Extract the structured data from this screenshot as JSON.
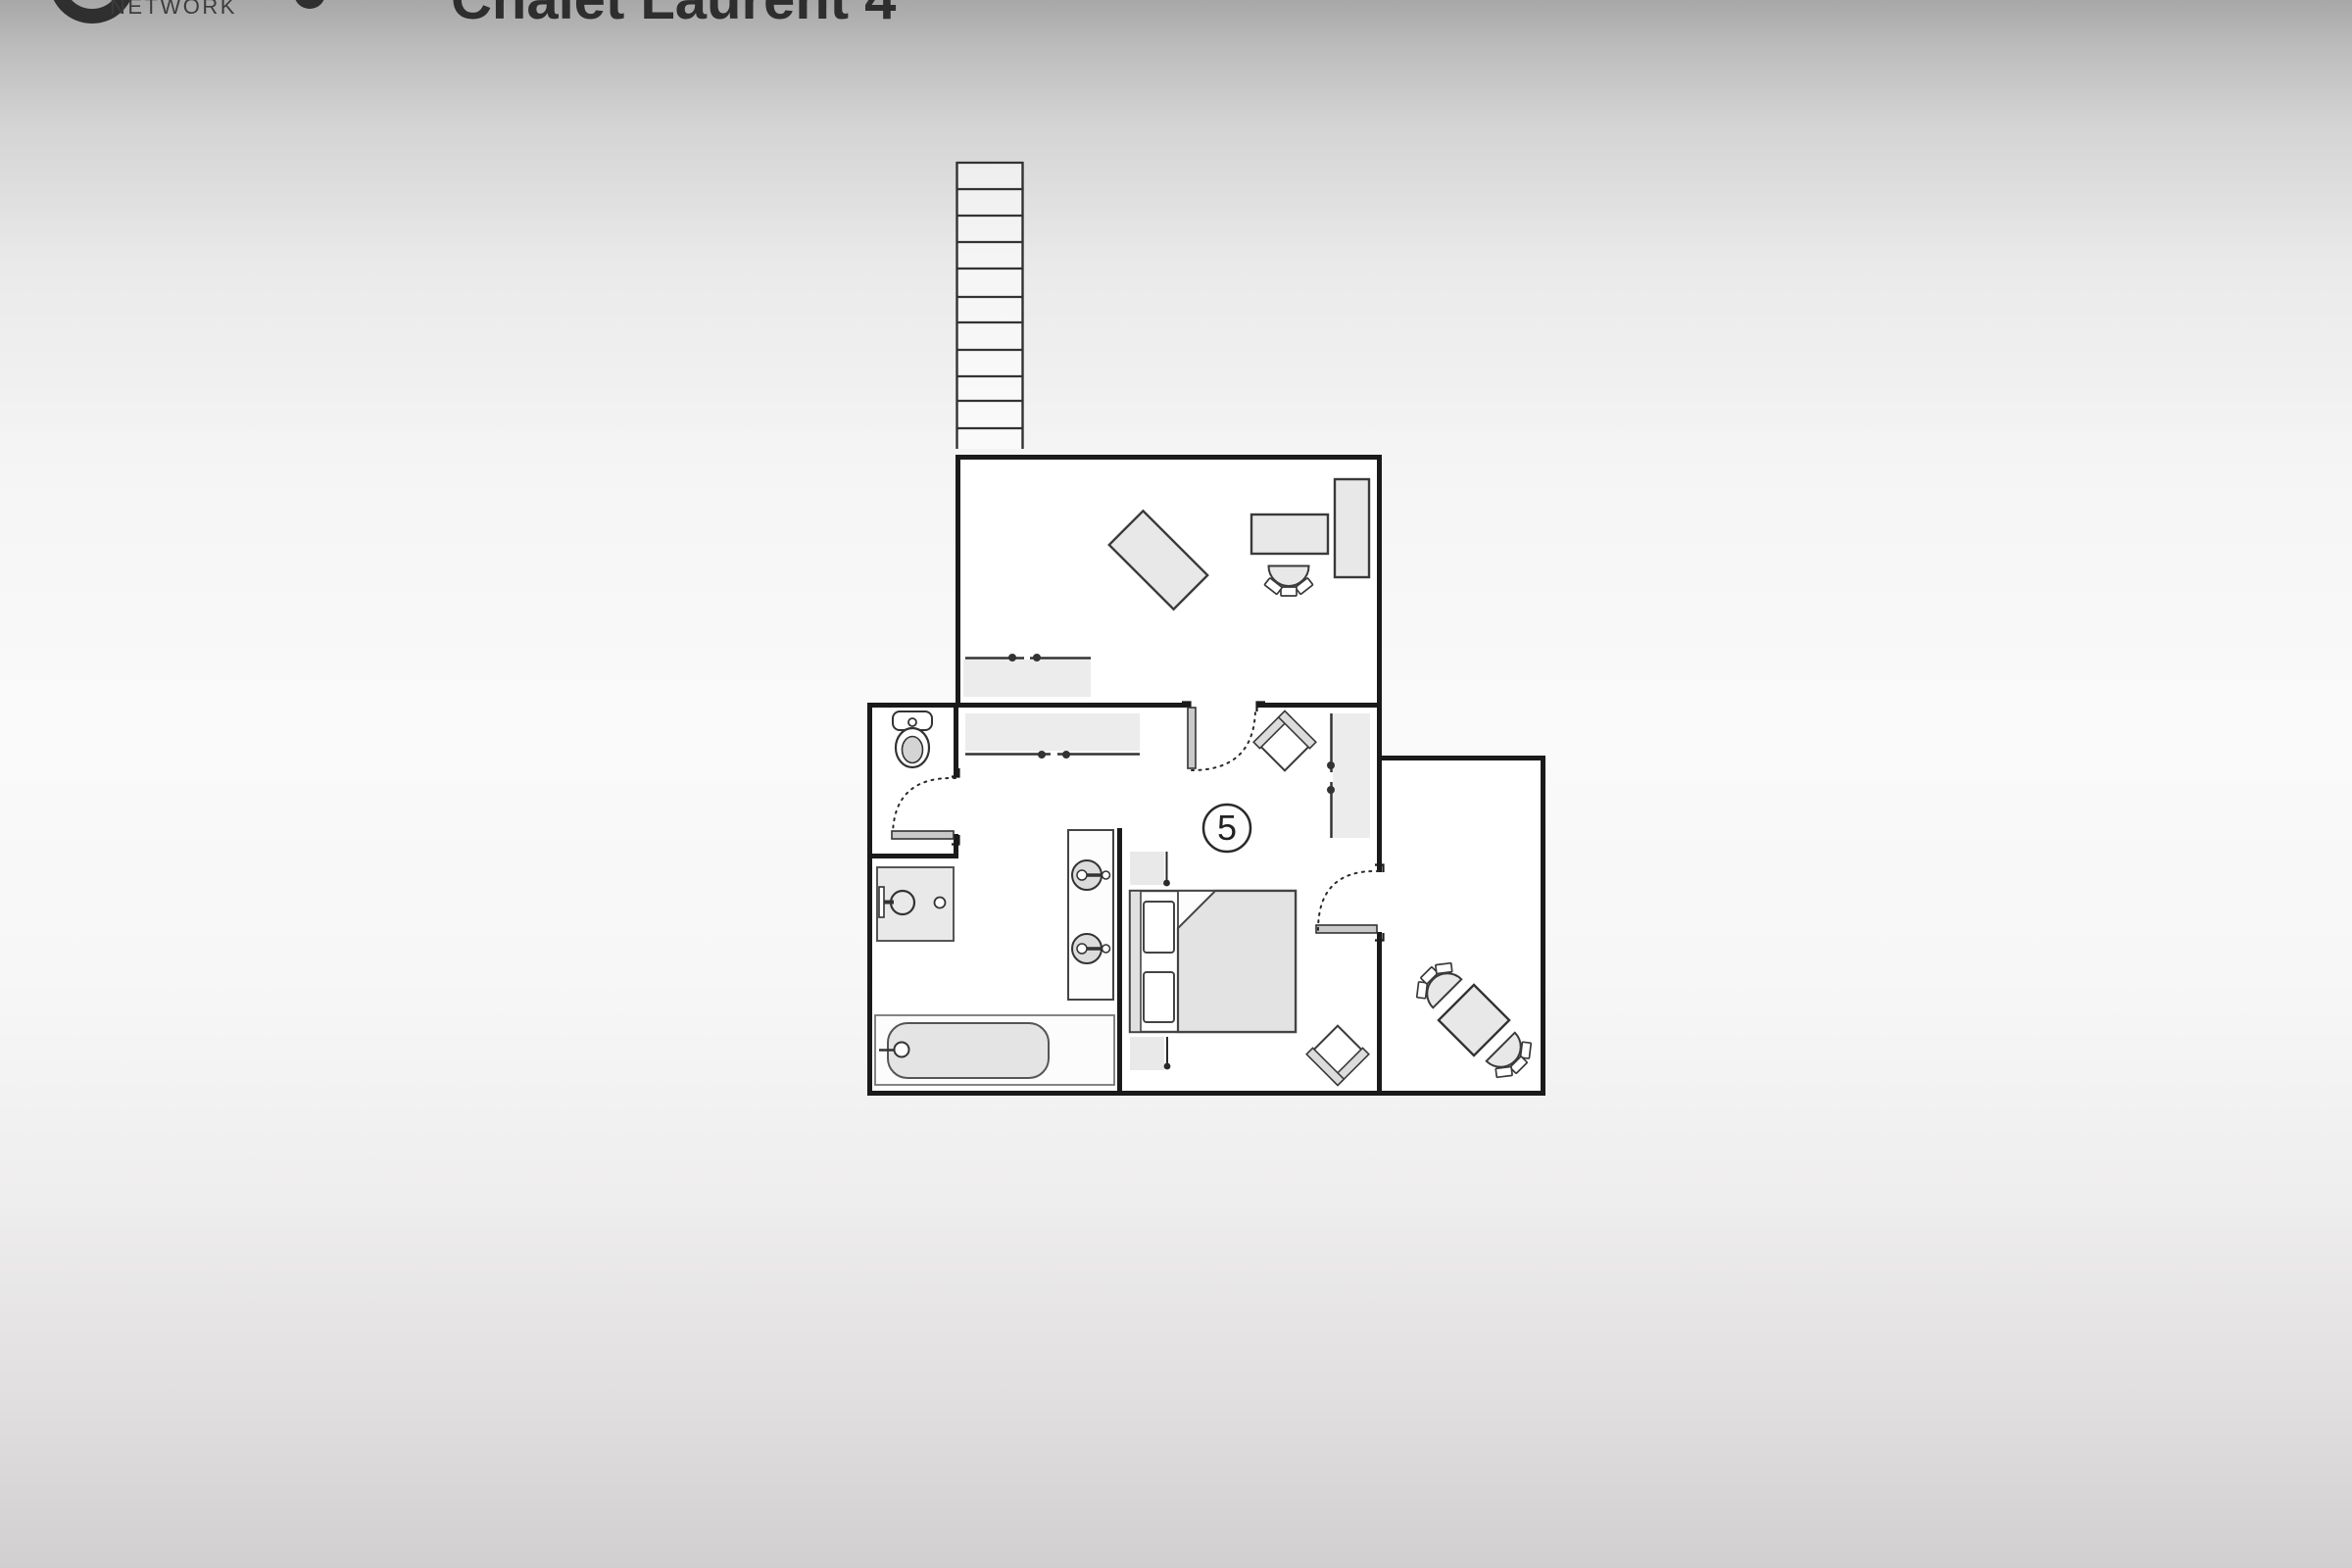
{
  "header": {
    "network_label": "NETWORK",
    "title": "Chalet Laurent 4"
  },
  "floor_plan": {
    "room_number": "5",
    "rooms": [
      "living-room",
      "hallway",
      "wc",
      "bathroom",
      "bedroom",
      "dining-nook"
    ],
    "furniture_icons": [
      "staircase",
      "area-rug",
      "desk",
      "desk-chair",
      "wardrobe",
      "sideboard",
      "toilet",
      "washbasin",
      "bathtub",
      "double-sink-vanity",
      "double-bed",
      "pillow",
      "nightstand",
      "reading-lamp",
      "armchair",
      "dining-table",
      "dining-chair",
      "door-swing"
    ],
    "colors": {
      "wall": "#1a1a1a",
      "furniture_outline": "#3a3a3a",
      "furniture_fill": "#e8e8e8",
      "floor": "#ffffff",
      "door_leaf": "#c9c9c9",
      "label_ink": "#222222"
    }
  }
}
